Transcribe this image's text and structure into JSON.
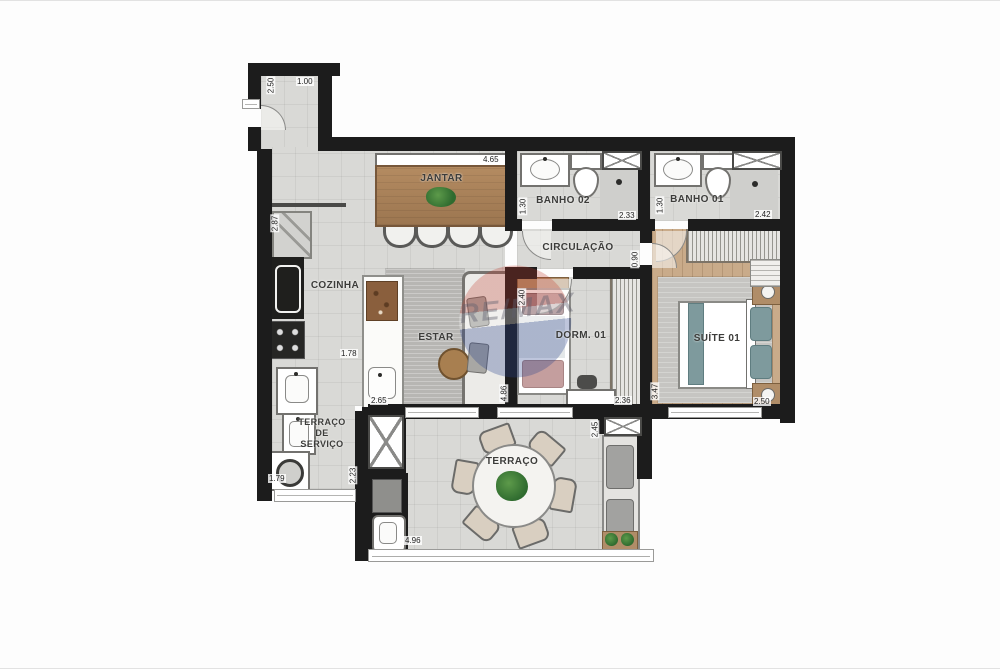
{
  "plan": {
    "watermark": "RE/MAX",
    "rooms": {
      "jantar": "JANTAR",
      "banho02": "BANHO 02",
      "banho01": "BANHO 01",
      "cozinha": "COZINHA",
      "circulacao": "CIRCULAÇÃO",
      "estar": "ESTAR",
      "dorm01": "DORM. 01",
      "suite01": "SUÍTE 01",
      "terraco_servico": "TERRAÇO\nDE\nSERVIÇO",
      "terraco": "TERRAÇO"
    },
    "dimensions": {
      "corridor_width": "2.50",
      "corridor_depth": "1.00",
      "jantar_width": "4.65",
      "banho02_width": "1.30",
      "banho02_length": "2.33",
      "banho01_width": "1.30",
      "banho01_length": "2.42",
      "cozinha_height": "2.87",
      "cozinha_width": "1.78",
      "island_length": "2.65",
      "circulacao_width": "0.90",
      "dorm01_width": "2.40",
      "dorm01_length": "2.36",
      "estar_length": "4.86",
      "suite_length": "3.47",
      "suite_width": "2.50",
      "terraco_depth": "2.45",
      "servico_width": "2.23",
      "servico_length": "1.79",
      "terraco_width": "4.96"
    },
    "palette": {
      "wall": "#1c1c1c",
      "floor": "#d9d9d6",
      "wood_floor": "#c9ab8a",
      "table_wood": "#a97f54",
      "teal_accent": "#7e9a9d",
      "plant_green": "#3f7d38",
      "remax_red": "#c0392b",
      "remax_blue": "#27408b"
    }
  }
}
